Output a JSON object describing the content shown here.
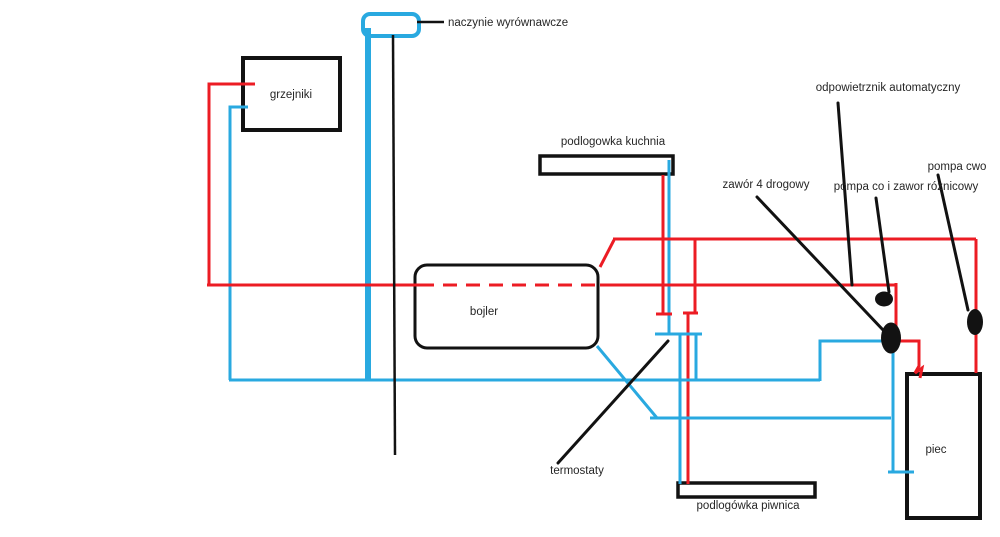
{
  "colors": {
    "hot_pipe": "#ec1c24",
    "cold_pipe": "#29a9e0",
    "ink": "#121212",
    "label_text": "#262626",
    "background": "#ffffff"
  },
  "labels": {
    "naczynie": "naczynie wyrównawcze",
    "grzejniki": "grzejniki",
    "kuchnia": "podlogowka kuchnia",
    "bojler": "bojler",
    "zawor4": "zawór 4 drogowy",
    "odpowietrznik": "odpowietrznik automatyczny",
    "pompa_co": "pompa co i zawor róznicowy",
    "pompa_cwo": "pompa cwo",
    "piec": "piec",
    "termostaty": "termostaty",
    "piwnica": "podlogówka piwnica"
  }
}
